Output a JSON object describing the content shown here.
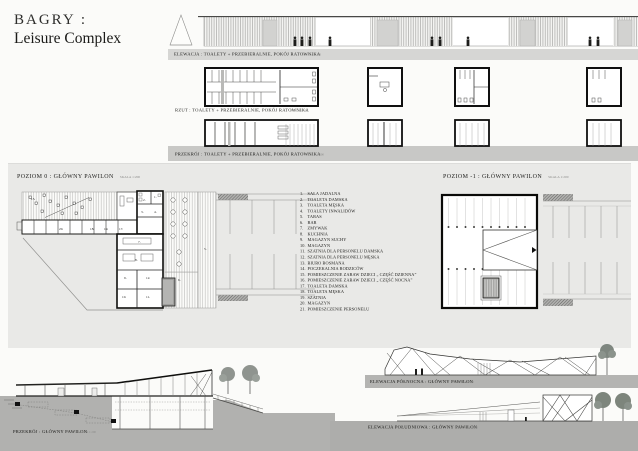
{
  "title": {
    "line1": "BAGRY :",
    "line2": "Leisure Complex"
  },
  "drawings": {
    "top_elevation": {
      "label": "ELEWACJA : TOALETY + PRZEBIERALNIE, POKÓJ RATOWNIKA",
      "scale": "SKALA 1:100"
    },
    "top_plan": {
      "label": "RZUT : TOALETY + PRZEBIERALNIE, POKÓJ RATOWNIKA",
      "scale": "SKALA 1:100"
    },
    "top_section": {
      "label": "PRZEKRÓJ : TOALETY + PRZEBIERALNIE, POKÓJ RATOWNIKA",
      "scale": "SKALA 1:100"
    },
    "plan_level0": {
      "label": "POZIOM 0 : GŁÓWNY PAWILON",
      "scale": "SKALA 1:200"
    },
    "plan_level_minus1": {
      "label": "POZIOM -1 : GŁÓWNY PAWILON",
      "scale": "SKALA 1:200"
    },
    "main_section": {
      "label": "PRZEKRÓJ : GŁÓWNY PAWILON",
      "scale": "SKALA 1:200"
    },
    "north_elevation": {
      "label": "ELEWACJA PÓŁNOCNA : GŁÓWNY PAWILON",
      "scale": "SKALA 1:200"
    },
    "south_elevation": {
      "label": "ELEWACJA POŁUDNIOWA : GŁÓWNY PAWILON",
      "scale": "SKALA 1:200"
    }
  },
  "legend": {
    "items": [
      {
        "n": "1.",
        "label": "SALA JADALNA"
      },
      {
        "n": "2.",
        "label": "TOALETA DAMSKA"
      },
      {
        "n": "3.",
        "label": "TOALETA MĘSKA"
      },
      {
        "n": "4.",
        "label": "TOALETY INWALIDÓW"
      },
      {
        "n": "5.",
        "label": "TARAS"
      },
      {
        "n": "6.",
        "label": "BAR"
      },
      {
        "n": "7.",
        "label": "ZMYWAK"
      },
      {
        "n": "8.",
        "label": "KUCHNIA"
      },
      {
        "n": "9.",
        "label": "MAGAZYN SUCHY"
      },
      {
        "n": "10.",
        "label": "MAGAZYN"
      },
      {
        "n": "11.",
        "label": "SZATNIA DLA PERSONELU DAMSKA"
      },
      {
        "n": "12.",
        "label": "SZATNIA DLA PERSONELU MĘSKA"
      },
      {
        "n": "13.",
        "label": "BIURO BOSMANA"
      },
      {
        "n": "14.",
        "label": "POCZEKALNIA RODZICÓW"
      },
      {
        "n": "15.",
        "label": "POMIESZCZENIE ZABAW DZIECI „ CZĘŚĆ DZIENNA”"
      },
      {
        "n": "16.",
        "label": "POMIESZCZENIE ZABAW DZIECI „ CZĘŚĆ NOCNA”"
      },
      {
        "n": "17.",
        "label": "TOALETA DAMSKA"
      },
      {
        "n": "18.",
        "label": "TOALETA MĘSKA"
      },
      {
        "n": "19.",
        "label": "SZATNIA"
      },
      {
        "n": "20.",
        "label": "MAGAZYN"
      },
      {
        "n": "21.",
        "label": "POMIESZCZENIE PERSONELU"
      }
    ]
  },
  "plan0": {
    "numbers": [
      "15.",
      "20.",
      "19.",
      "18.",
      "17.",
      "1.",
      "2.",
      "3.",
      "4.",
      "5.",
      "6.",
      "7.",
      "8.",
      "9.",
      "10.",
      "11.",
      "12."
    ]
  },
  "colors": {
    "panel": "#e9e9e7",
    "ground": "#b1b1af",
    "section_band": "#c8c8c6",
    "label_band": "#d6d6d4",
    "wall": "#111111"
  }
}
